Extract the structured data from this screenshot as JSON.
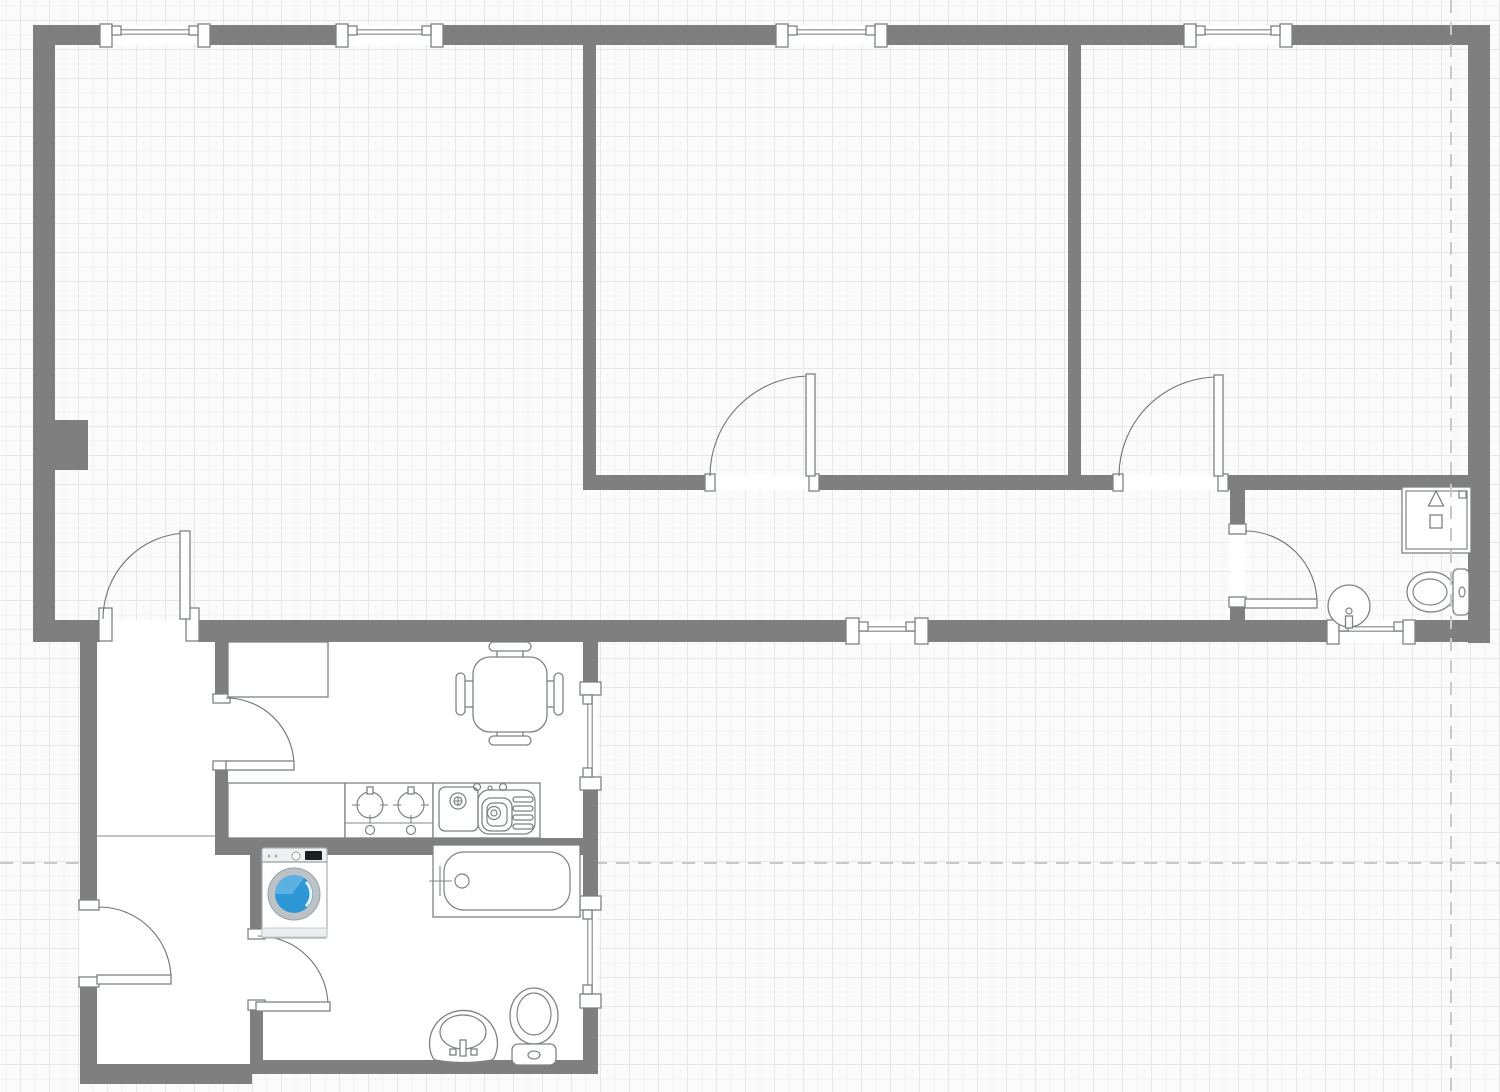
{
  "canvas": {
    "width": 1500,
    "height": 1092,
    "background": "#fbfbfb",
    "grid_size": 29,
    "grid_color": "#e7e7e7",
    "wall_color": "#7f7f7f",
    "symbol_stroke": "#7e8284",
    "floor_fill": "#ffffff",
    "guide_color": "#c9c9c9",
    "washer_accent": "#2d98d5"
  },
  "guides": {
    "vertical_x": 1451,
    "horizontal_y": 863
  },
  "fills": [
    {
      "name": "vestibule-upper",
      "x": 97,
      "y": 640,
      "w": 118,
      "h": 200
    },
    {
      "name": "vestibule-lower",
      "x": 97,
      "y": 838,
      "w": 153,
      "h": 226
    },
    {
      "name": "kitchen",
      "x": 228,
      "y": 642,
      "w": 355,
      "h": 198
    },
    {
      "name": "bathroom",
      "x": 263,
      "y": 853,
      "w": 320,
      "h": 209
    }
  ],
  "walls": [
    {
      "name": "wall-top",
      "x": 33,
      "y": 25,
      "w": 1457,
      "h": 20
    },
    {
      "name": "wall-left",
      "x": 33,
      "y": 25,
      "w": 22,
      "h": 617
    },
    {
      "name": "wall-right",
      "x": 1468,
      "y": 25,
      "w": 22,
      "h": 618
    },
    {
      "name": "wall-bottom-main",
      "x": 33,
      "y": 620,
      "w": 1457,
      "h": 22
    },
    {
      "name": "wall-pillar",
      "x": 55,
      "y": 420,
      "w": 33,
      "h": 50
    },
    {
      "name": "wall-interior-west",
      "x": 583,
      "y": 45,
      "w": 13,
      "h": 430
    },
    {
      "name": "wall-interior-east",
      "x": 1068,
      "y": 45,
      "w": 13,
      "h": 430
    },
    {
      "name": "wall-bedrooms-south",
      "x": 583,
      "y": 475,
      "w": 885,
      "h": 15
    },
    {
      "name": "wall-wc-west",
      "x": 1230,
      "y": 475,
      "w": 15,
      "h": 167
    },
    {
      "name": "wall-kitchen-west",
      "x": 215,
      "y": 642,
      "w": 13,
      "h": 198
    },
    {
      "name": "wall-kitchen-east",
      "x": 583,
      "y": 642,
      "w": 15,
      "h": 198
    },
    {
      "name": "wall-kitchen-south",
      "x": 215,
      "y": 838,
      "w": 383,
      "h": 17
    },
    {
      "name": "wall-bath-west-upper",
      "x": 250,
      "y": 840,
      "w": 13,
      "h": 95
    },
    {
      "name": "wall-bath-west-lower",
      "x": 250,
      "y": 1010,
      "w": 13,
      "h": 54
    },
    {
      "name": "wall-bath-east",
      "x": 583,
      "y": 853,
      "w": 15,
      "h": 221
    },
    {
      "name": "wall-bath-south",
      "x": 250,
      "y": 1060,
      "w": 348,
      "h": 14
    },
    {
      "name": "wall-vestibule-west",
      "x": 80,
      "y": 640,
      "w": 17,
      "h": 444
    },
    {
      "name": "wall-vestibule-south",
      "x": 80,
      "y": 1064,
      "w": 172,
      "h": 20
    }
  ],
  "room_divider": {
    "x1": 97,
    "y1": 836,
    "x2": 215,
    "y2": 836
  },
  "windows": [
    {
      "name": "window-living-1",
      "dir": "h",
      "open": [
        101,
        25,
        109,
        20
      ],
      "posts": [
        [
          100,
          24,
          12,
          23
        ],
        [
          198,
          24,
          12,
          23
        ]
      ],
      "glass": [
        112,
        32,
        198,
        32
      ],
      "brackets": [
        [
          112,
          26,
          9,
          9
        ],
        [
          189,
          26,
          9,
          9
        ]
      ]
    },
    {
      "name": "window-living-2",
      "dir": "h",
      "open": [
        337,
        25,
        106,
        20
      ],
      "posts": [
        [
          336,
          24,
          12,
          23
        ],
        [
          431,
          24,
          12,
          23
        ]
      ],
      "glass": [
        348,
        32,
        431,
        32
      ],
      "brackets": [
        [
          348,
          26,
          9,
          9
        ],
        [
          422,
          26,
          9,
          9
        ]
      ]
    },
    {
      "name": "window-bedroom1",
      "dir": "h",
      "open": [
        777,
        25,
        110,
        20
      ],
      "posts": [
        [
          776,
          24,
          12,
          23
        ],
        [
          875,
          24,
          12,
          23
        ]
      ],
      "glass": [
        788,
        32,
        875,
        32
      ],
      "brackets": [
        [
          788,
          26,
          9,
          9
        ],
        [
          866,
          26,
          9,
          9
        ]
      ]
    },
    {
      "name": "window-bedroom2",
      "dir": "h",
      "open": [
        1185,
        25,
        107,
        20
      ],
      "posts": [
        [
          1184,
          24,
          12,
          23
        ],
        [
          1280,
          24,
          12,
          23
        ]
      ],
      "glass": [
        1196,
        32,
        1280,
        32
      ],
      "brackets": [
        [
          1196,
          26,
          9,
          9
        ],
        [
          1271,
          26,
          9,
          9
        ]
      ]
    },
    {
      "name": "window-hall",
      "dir": "h",
      "open": [
        847,
        620,
        81,
        22
      ],
      "posts": [
        [
          846,
          618,
          13,
          26
        ],
        [
          915,
          618,
          13,
          26
        ]
      ],
      "glass": [
        859,
        629,
        915,
        629
      ],
      "brackets": [
        [
          859,
          622,
          9,
          9
        ],
        [
          906,
          622,
          9,
          9
        ]
      ]
    },
    {
      "name": "window-wc",
      "dir": "h",
      "open": [
        1328,
        620,
        87,
        22
      ],
      "posts": [
        [
          1327,
          620,
          12,
          24
        ],
        [
          1403,
          620,
          12,
          24
        ]
      ],
      "glass": [
        1339,
        629,
        1403,
        629
      ],
      "brackets": [
        [
          1339,
          622,
          9,
          9
        ],
        [
          1394,
          622,
          9,
          9
        ]
      ]
    },
    {
      "name": "window-kitchen",
      "dir": "v",
      "open": [
        583,
        683,
        15,
        107
      ],
      "posts": [
        [
          580,
          682,
          21,
          13
        ],
        [
          580,
          777,
          21,
          13
        ]
      ],
      "glass": [
        590,
        695,
        590,
        777
      ],
      "brackets": [
        [
          583,
          695,
          9,
          9
        ],
        [
          583,
          768,
          9,
          9
        ]
      ]
    },
    {
      "name": "window-bathroom",
      "dir": "v",
      "open": [
        583,
        897,
        15,
        111
      ],
      "posts": [
        [
          580,
          896,
          21,
          14
        ],
        [
          580,
          994,
          21,
          14
        ]
      ],
      "glass": [
        590,
        910,
        590,
        994
      ],
      "brackets": [
        [
          583,
          910,
          9,
          9
        ],
        [
          583,
          985,
          9,
          9
        ]
      ]
    }
  ],
  "doors": [
    {
      "name": "door-hall-entry",
      "open": [
        100,
        620,
        98,
        22
      ],
      "jambs": [
        [
          99,
          608,
          13,
          33
        ],
        [
          186,
          608,
          13,
          33
        ]
      ],
      "leaf": [
        180,
        531,
        10,
        88
      ],
      "arc": {
        "sx": 185,
        "sy": 533,
        "ex": 103,
        "ey": 619,
        "r": 86,
        "sweep": 0
      }
    },
    {
      "name": "door-bedroom1",
      "open": [
        710,
        475,
        104,
        15
      ],
      "jambs": [
        [
          705,
          474,
          10,
          17
        ],
        [
          809,
          474,
          10,
          17
        ]
      ],
      "leaf": [
        806,
        374,
        9,
        102
      ],
      "arc": {
        "sx": 810,
        "sy": 376,
        "ex": 710,
        "ey": 476,
        "r": 100,
        "sweep": 0
      }
    },
    {
      "name": "door-bedroom2",
      "open": [
        1118,
        475,
        106,
        15
      ],
      "jambs": [
        [
          1113,
          474,
          10,
          17
        ],
        [
          1218,
          474,
          10,
          17
        ]
      ],
      "leaf": [
        1214,
        375,
        9,
        101
      ],
      "arc": {
        "sx": 1218,
        "sy": 377,
        "ex": 1119,
        "ey": 476,
        "r": 99,
        "sweep": 0
      }
    },
    {
      "name": "door-wc",
      "open": [
        1230,
        527,
        15,
        77
      ],
      "jambs": [
        [
          1229,
          524,
          17,
          10
        ],
        [
          1229,
          597,
          17,
          10
        ]
      ],
      "leaf": [
        1245,
        599,
        72,
        9
      ],
      "arc": {
        "sx": 1245,
        "sy": 531,
        "ex": 1317,
        "ey": 603,
        "r": 72,
        "sweep": 1
      }
    },
    {
      "name": "door-kitchen",
      "open": [
        215,
        698,
        13,
        70
      ],
      "jambs": [
        [
          213,
          694,
          17,
          9
        ],
        [
          213,
          761,
          17,
          9
        ]
      ],
      "leaf": [
        226,
        761,
        68,
        9
      ],
      "arc": {
        "sx": 226,
        "sy": 698,
        "ex": 294,
        "ey": 765,
        "r": 68,
        "sweep": 1
      }
    },
    {
      "name": "door-apartment-entry",
      "open": [
        80,
        905,
        17,
        78
      ],
      "jambs": [
        [
          79,
          900,
          20,
          10
        ],
        [
          79,
          977,
          20,
          10
        ]
      ],
      "leaf": [
        97,
        975,
        74,
        9
      ],
      "arc": {
        "sx": 99,
        "sy": 907,
        "ex": 171,
        "ey": 979,
        "r": 72,
        "sweep": 1
      }
    },
    {
      "name": "door-bathroom",
      "open": [
        250,
        935,
        13,
        75
      ],
      "jambs": [
        [
          248,
          929,
          17,
          10
        ],
        [
          248,
          1000,
          17,
          10
        ]
      ],
      "leaf": [
        256,
        1002,
        74,
        9
      ],
      "arc": {
        "sx": 258,
        "sy": 936,
        "ex": 328,
        "ey": 1006,
        "r": 70,
        "sweep": 1
      }
    }
  ],
  "fixtures": [
    {
      "type": "cabinet",
      "name": "kitchen-cabinet",
      "x": 228,
      "y": 642,
      "w": 100,
      "h": 55
    },
    {
      "type": "counter",
      "name": "kitchen-counter",
      "x": 228,
      "y": 783,
      "w": 117,
      "h": 55
    },
    {
      "type": "stove",
      "name": "stove",
      "x": 345,
      "y": 783,
      "w": 88,
      "h": 55
    },
    {
      "type": "sink_unit",
      "name": "kitchen-sink",
      "x": 433,
      "y": 783,
      "w": 107,
      "h": 55
    },
    {
      "type": "table_set",
      "name": "dining-table-set",
      "table": [
        473,
        657,
        74,
        75
      ],
      "chairs": [
        {
          "pill": [
            489,
            642,
            42,
            9
          ],
          "seat": [
            497,
            650,
            26,
            8
          ]
        },
        {
          "pill": [
            489,
            736,
            42,
            9
          ],
          "seat": [
            497,
            730,
            26,
            7
          ]
        },
        {
          "pill": [
            456,
            673,
            9,
            42
          ],
          "seat": [
            464,
            681,
            10,
            26
          ]
        },
        {
          "pill": [
            554,
            673,
            9,
            42
          ],
          "seat": [
            546,
            681,
            9,
            26
          ]
        }
      ]
    },
    {
      "type": "washer",
      "name": "washing-machine",
      "x": 262,
      "y": 848,
      "w": 65,
      "h": 90
    },
    {
      "type": "bathtub",
      "name": "bathtub",
      "x": 433,
      "y": 845,
      "w": 147,
      "h": 72
    },
    {
      "type": "pedestal_sink",
      "name": "bathroom-sink",
      "cx": 463,
      "cy": 1032
    },
    {
      "type": "toilet_up",
      "name": "bathroom-toilet",
      "x": 510,
      "y": 988,
      "w": 48,
      "h": 78
    },
    {
      "type": "shower",
      "name": "shower",
      "x": 1402,
      "y": 487,
      "w": 69,
      "h": 66
    },
    {
      "type": "toilet_right",
      "name": "wc-toilet",
      "cx": 1431,
      "cy": 592
    },
    {
      "type": "round_sink",
      "name": "wc-washbasin",
      "cx": 1349,
      "cy": 606,
      "r": 21
    }
  ]
}
